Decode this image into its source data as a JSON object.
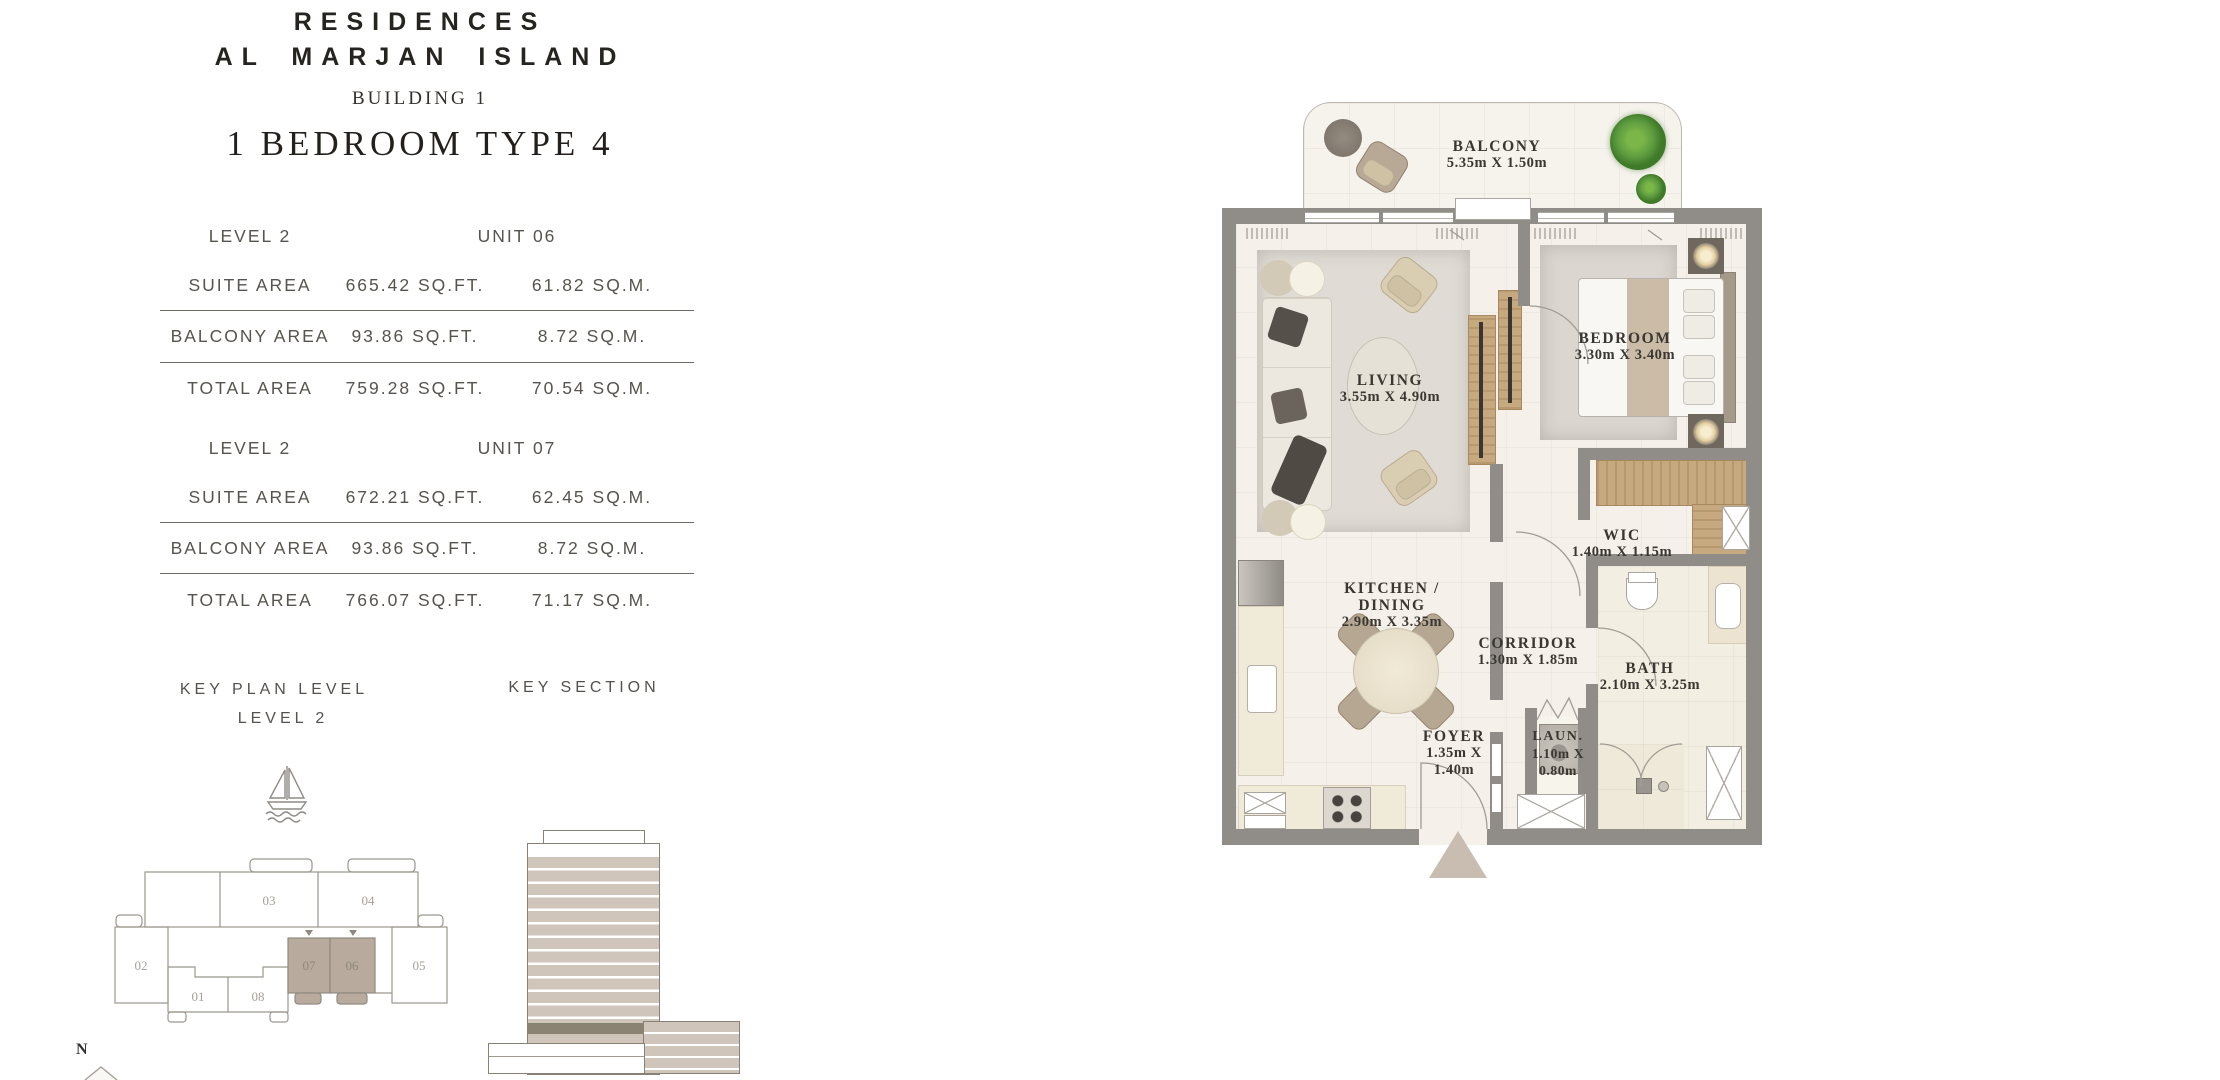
{
  "header": {
    "brand_line1": "RESIDENCES",
    "brand_line2": "AL MARJAN ISLAND",
    "building": "BUILDING 1",
    "unit_type": "1 BEDROOM TYPE 4"
  },
  "tables": [
    {
      "level": "LEVEL 2",
      "unit": "UNIT 06",
      "rows": [
        {
          "label": "SUITE AREA",
          "sqft": "665.42 SQ.FT.",
          "sqm": "61.82 SQ.M."
        },
        {
          "label": "BALCONY AREA",
          "sqft": "93.86 SQ.FT.",
          "sqm": "8.72 SQ.M."
        },
        {
          "label": "TOTAL AREA",
          "sqft": "759.28 SQ.FT.",
          "sqm": "70.54 SQ.M."
        }
      ]
    },
    {
      "level": "LEVEL 2",
      "unit": "UNIT 07",
      "rows": [
        {
          "label": "SUITE AREA",
          "sqft": "672.21 SQ.FT.",
          "sqm": "62.45 SQ.M."
        },
        {
          "label": "BALCONY AREA",
          "sqft": "93.86 SQ.FT.",
          "sqm": "8.72 SQ.M."
        },
        {
          "label": "TOTAL AREA",
          "sqft": "766.07 SQ.FT.",
          "sqm": "71.17 SQ.M."
        }
      ]
    }
  ],
  "key_plan": {
    "title_line1": "KEY PLAN LEVEL",
    "title_line2": "LEVEL 2",
    "north_label": "N",
    "highlighted_units": [
      "06",
      "07"
    ],
    "units": {
      "u01": "01",
      "u02": "02",
      "u03": "03",
      "u04": "04",
      "u05": "05",
      "u06": "06",
      "u07": "07",
      "u08": "08"
    }
  },
  "key_section": {
    "title": "KEY SECTION"
  },
  "floor_plan": {
    "rooms": {
      "balcony": {
        "name": "BALCONY",
        "dims": "5.35m X 1.50m"
      },
      "living": {
        "name": "LIVING",
        "dims": "3.55m X 4.90m"
      },
      "bedroom": {
        "name": "BEDROOM",
        "dims": "3.30m X 3.40m"
      },
      "wic": {
        "name": "WIC",
        "dims": "1.40m X 1.15m"
      },
      "kitchen": {
        "name": "KITCHEN / DINING",
        "dims": "2.90m X 3.35m"
      },
      "corridor": {
        "name": "CORRIDOR",
        "dims": "1.30m X 1.85m"
      },
      "foyer": {
        "name": "FOYER",
        "dims1": "1.35m X",
        "dims2": "1.40m"
      },
      "laundry": {
        "name": "LAUN.",
        "dims1": "1.10m X",
        "dims2": "0.80m"
      },
      "bath": {
        "name": "BATH",
        "dims": "2.10m X 3.25m"
      }
    },
    "colors": {
      "wall": "#908d88",
      "floor": "#f5f1ea",
      "wood": "#c7a97f",
      "unit_highlight": "#b8ab9d",
      "plan_text": "#3a3732",
      "table_text": "#57534e",
      "rule_line": "#6e6b67",
      "plant_green": "#5e9c40",
      "entry_arrow": "#c9bcb0"
    }
  }
}
